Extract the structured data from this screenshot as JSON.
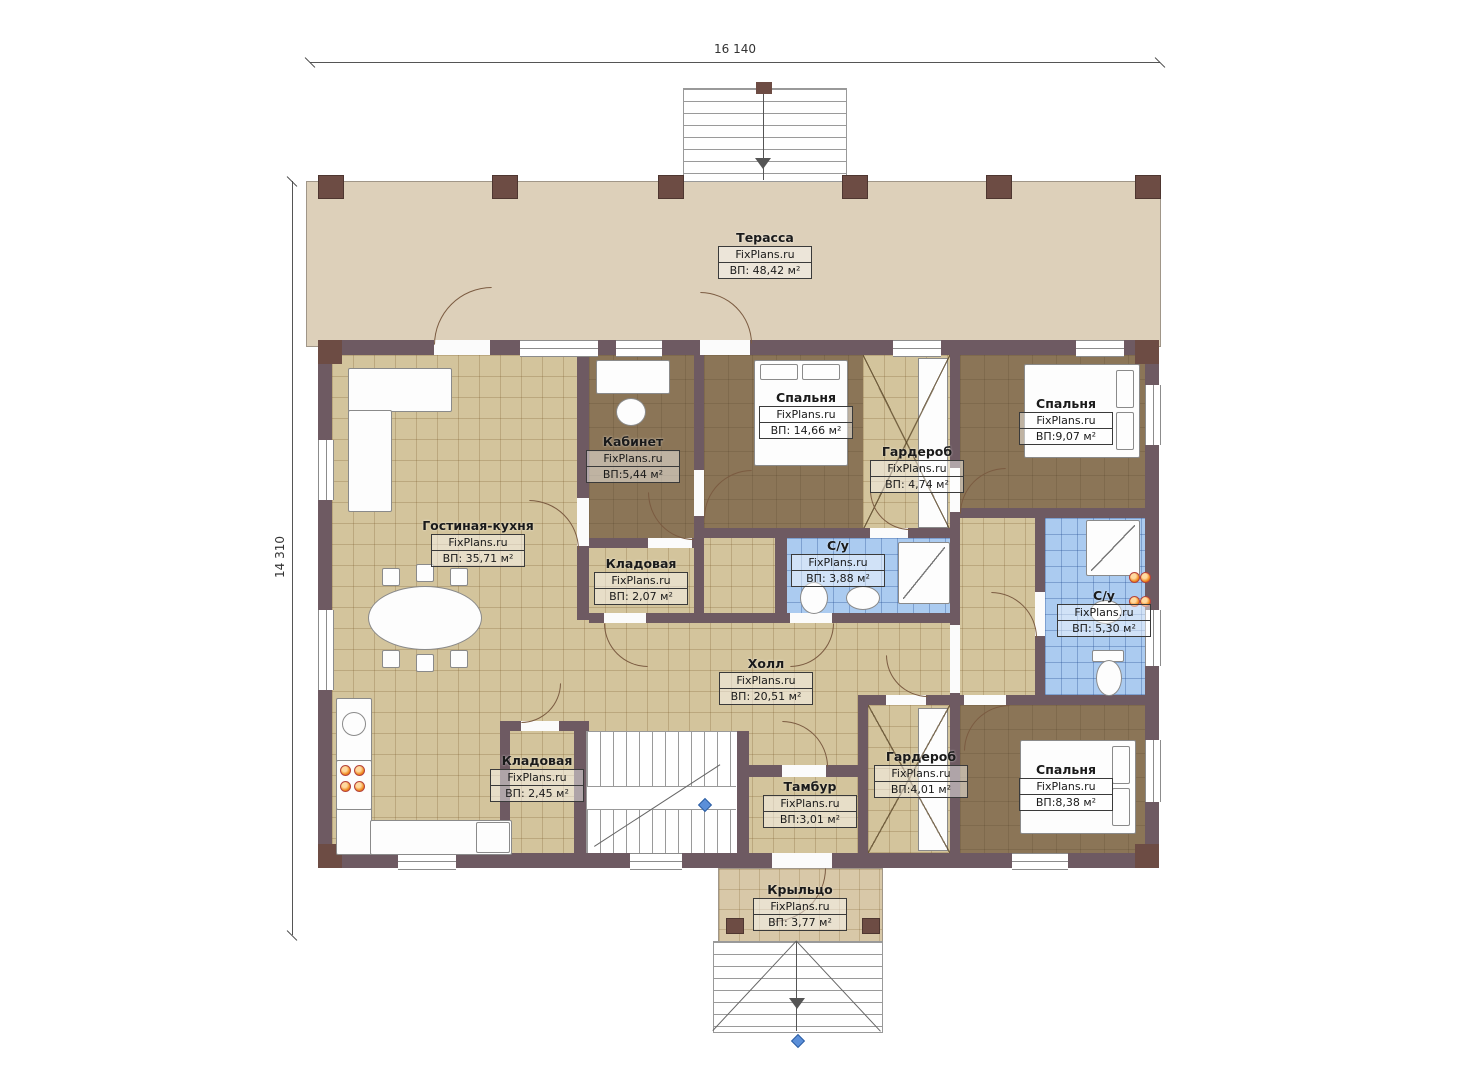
{
  "brand": "FixPlans.ru",
  "dimensions": {
    "width": "16 140",
    "height": "14 310"
  },
  "rooms": [
    {
      "name": "Терасса",
      "area": "ВП: 48,42 м²"
    },
    {
      "name": "Гостиная-кухня",
      "area": "ВП: 35,71 м²"
    },
    {
      "name": "Кабинет",
      "area": "ВП:5,44 м²"
    },
    {
      "name": "Спальня",
      "area": "ВП: 14,66 м²"
    },
    {
      "name": "Гардероб",
      "area": "ВП: 4,74 м²"
    },
    {
      "name": "Спальня",
      "area": "ВП:9,07 м²"
    },
    {
      "name": "С/у",
      "area": "ВП: 3,88 м²"
    },
    {
      "name": "Кладовая",
      "area": "ВП: 2,07 м²"
    },
    {
      "name": "С/у",
      "area": "ВП: 5,30 м²"
    },
    {
      "name": "Холл",
      "area": "ВП: 20,51 м²"
    },
    {
      "name": "Кладовая",
      "area": "ВП: 2,45 м²"
    },
    {
      "name": "Тамбур",
      "area": "ВП:3,01 м²"
    },
    {
      "name": "Гардероб",
      "area": "ВП:4,01 м²"
    },
    {
      "name": "Спальня",
      "area": "ВП:8,38 м²"
    },
    {
      "name": "Крыльцо",
      "area": "ВП: 3,77 м²"
    }
  ],
  "colors": {
    "wall": "#6e5a62",
    "post": "#6d4c44",
    "floor_tan": "#d3c49c",
    "floor_dark": "#8b7557",
    "floor_blue": "#abcbf0",
    "terrace": "#ddd0ba",
    "burner_orange": "#f08a1e",
    "marker_blue": "#5b8fd9"
  }
}
